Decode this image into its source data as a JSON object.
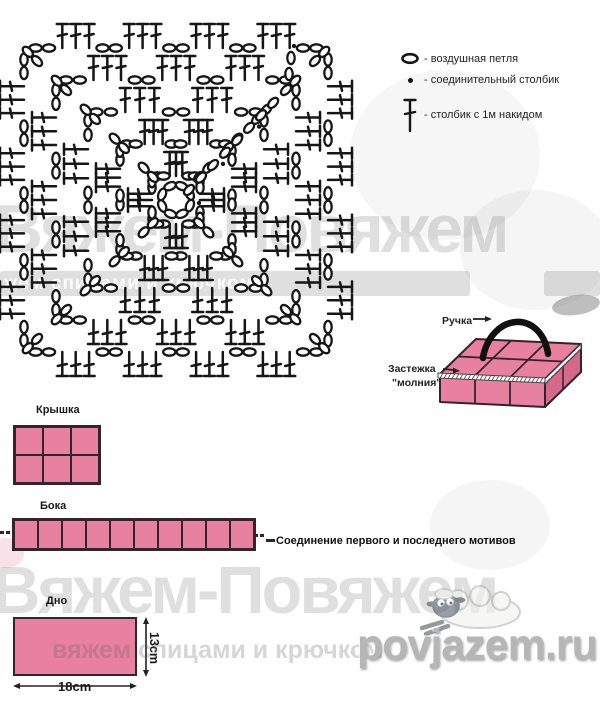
{
  "legend": {
    "items": [
      {
        "name": "chain",
        "label": "- воздушная петля"
      },
      {
        "name": "slip-stitch",
        "label": "- соединительный столбик"
      },
      {
        "name": "double-crochet",
        "label": "- столбик с 1м накидом"
      }
    ]
  },
  "bag": {
    "handle_label": "Ручка",
    "zipper_label_line1": "Застежка",
    "zipper_label_line2": "\"молния\""
  },
  "parts": {
    "lid": {
      "label": "Крышка",
      "cols": 3,
      "rows": 2
    },
    "sides": {
      "label": "Бока",
      "cells": 10,
      "join_note": "Соединение первого и последнего мотивов"
    },
    "bottom": {
      "label": "Дно",
      "width_label": "18cm",
      "height_label": "13cm"
    }
  },
  "watermarks": {
    "brand": "Вяжем-Повяжем",
    "tagline_mid": "жем спицами и крючком",
    "tagline_bottom": "вяжем спицами и крючком",
    "site": "povjazem.ru"
  },
  "colors": {
    "pink": "#e8809f",
    "pink_dark": "#d4698b",
    "outline": "#35222c",
    "symbol": "#161616"
  }
}
